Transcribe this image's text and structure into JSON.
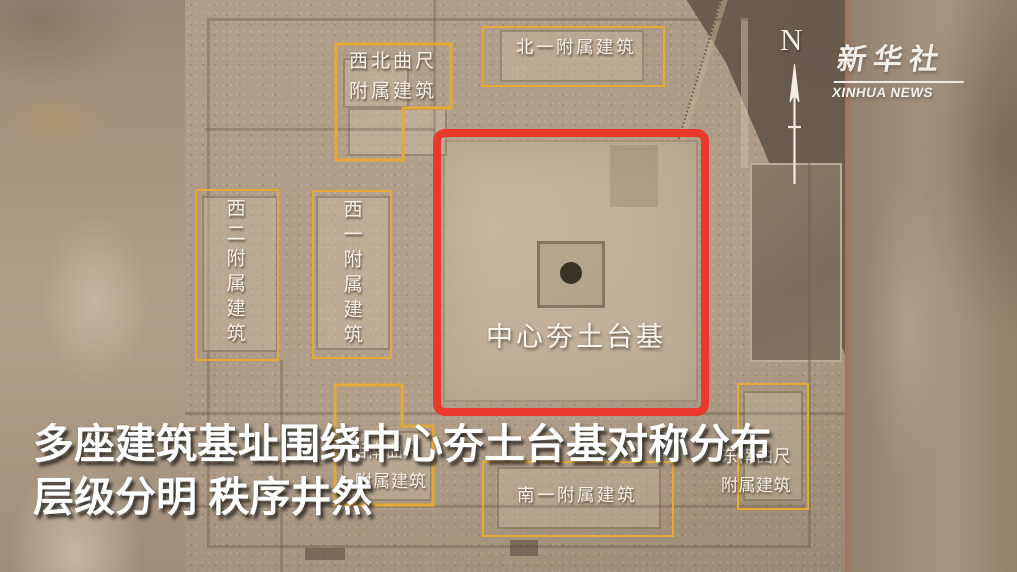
{
  "branding": {
    "logo_cn": "新华社",
    "logo_en": "XINHUA NEWS"
  },
  "compass": {
    "label": "N"
  },
  "caption": {
    "line1": "多座建筑基址围绕中心夯土台基对称分布",
    "line2": "层级分明 秩序井然"
  },
  "annotations": {
    "northwest": {
      "line1": "西北曲尺",
      "line2": "附属建筑"
    },
    "north1": {
      "label": "北一附属建筑"
    },
    "west2": {
      "label": "西二附属建筑"
    },
    "west1": {
      "label": "西一附属建筑"
    },
    "center": {
      "label": "中心夯土台基"
    },
    "southwest": {
      "line1": "西南曲尺",
      "line2": "附属建筑"
    },
    "south1": {
      "label": "南一附属建筑"
    },
    "southeast": {
      "line1": "东南曲尺",
      "line2": "附属建筑"
    }
  },
  "colors": {
    "annotation_yellow": "#e3ab36",
    "highlight_red": "#ea392c",
    "label_white": "#f6f0e6"
  }
}
